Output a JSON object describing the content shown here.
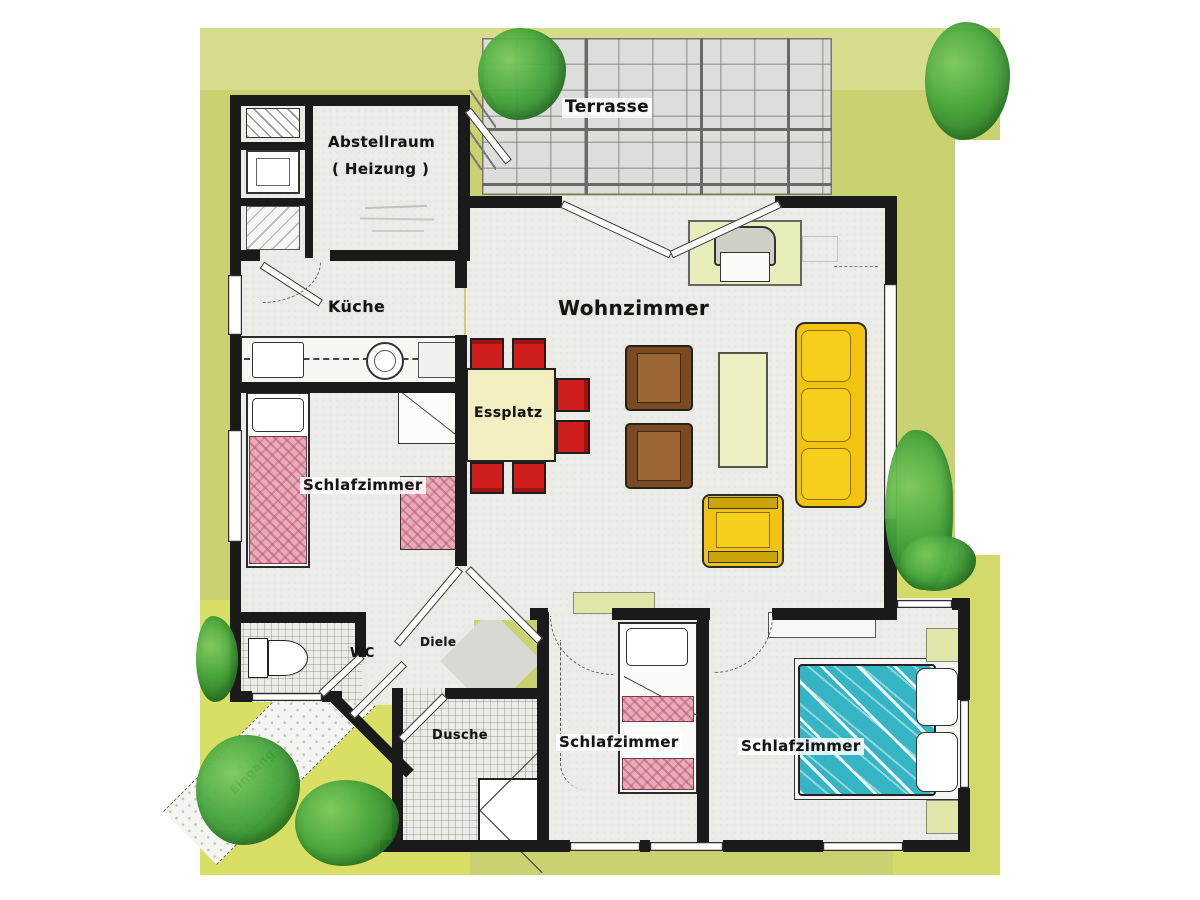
{
  "plan": {
    "labels": {
      "terrasse": "Terrasse",
      "abstellraum_line1": "Abstellraum",
      "abstellraum_line2": "( Heizung )",
      "kueche": "Küche",
      "wohnzimmer": "Wohnzimmer",
      "essplatz": "Essplatz",
      "schlafzimmer_left": "Schlafzimmer",
      "wc": "WC",
      "diele": "Diele",
      "dusche": "Dusche",
      "schlafzimmer_mid": "Schlafzimmer",
      "schlafzimmer_right": "Schlafzimmer",
      "eingang": "Eingang"
    },
    "colors": {
      "wall": "#1a1a1a",
      "lawn": "#c9d171",
      "lawn_band": "#d8dd90",
      "lawn_bright": "#dfe45f",
      "terrace": "#dddddb",
      "floor": "#ebebe7",
      "chair_red": "#cf1e1e",
      "table_cream": "#f3efc2",
      "armchair_brown": "#7b4a22",
      "armchair_brown_seat": "#9c6733",
      "sofa_yellow": "#f2c411",
      "coffee_table": "#eef0c4",
      "tv_board": "#e9edba",
      "bed_pink": "#e5aebc",
      "bed_teal": "#35b4c4",
      "mat_green": "#dfe6a8"
    }
  }
}
